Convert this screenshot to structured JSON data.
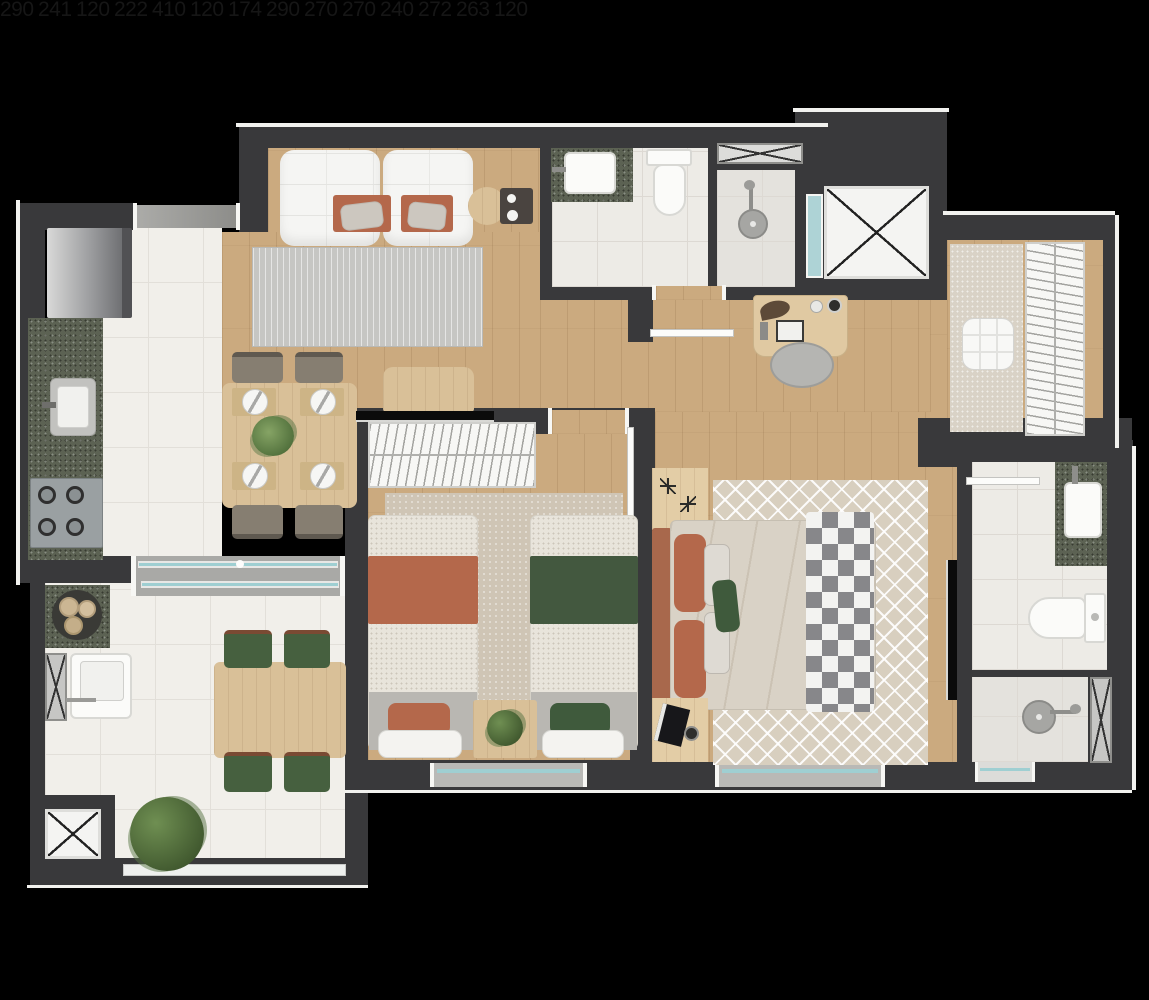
{
  "plan": {
    "type": "apartment-floor-plan",
    "dimension_labels": [
      {
        "value": "290",
        "area": "kitchen",
        "orientation": "vertical"
      },
      {
        "value": "241",
        "area": "living-room",
        "orientation": "horizontal"
      },
      {
        "value": "120",
        "area": "bathroom-1",
        "orientation": "vertical"
      },
      {
        "value": "222",
        "area": "bathroom-1",
        "orientation": "horizontal"
      },
      {
        "value": "410",
        "area": "hallway",
        "orientation": "vertical"
      },
      {
        "value": "120",
        "area": "closet",
        "orientation": "horizontal"
      },
      {
        "value": "174",
        "area": "closet",
        "orientation": "vertical"
      },
      {
        "value": "290",
        "area": "bedroom-2",
        "orientation": "vertical"
      },
      {
        "value": "270",
        "area": "kitchen-stove",
        "orientation": "horizontal"
      },
      {
        "value": "270",
        "area": "balcony",
        "orientation": "vertical"
      },
      {
        "value": "240",
        "area": "bedroom-2",
        "orientation": "horizontal"
      },
      {
        "value": "272",
        "area": "master-bedroom",
        "orientation": "horizontal"
      },
      {
        "value": "263",
        "area": "bathroom-2",
        "orientation": "vertical"
      },
      {
        "value": "120",
        "area": "bathroom-2",
        "orientation": "horizontal"
      }
    ],
    "colors": {
      "background": "#000000",
      "wall": "#39393b",
      "wood_floor": "#cbaa7f",
      "tile_floor": "#f1efea",
      "granite_counter": "#5c6253",
      "window_glass": "#aed3d6",
      "terracotta_textile": "#b4684b",
      "green_textile": "#46603f",
      "label_text": "#161616"
    }
  }
}
